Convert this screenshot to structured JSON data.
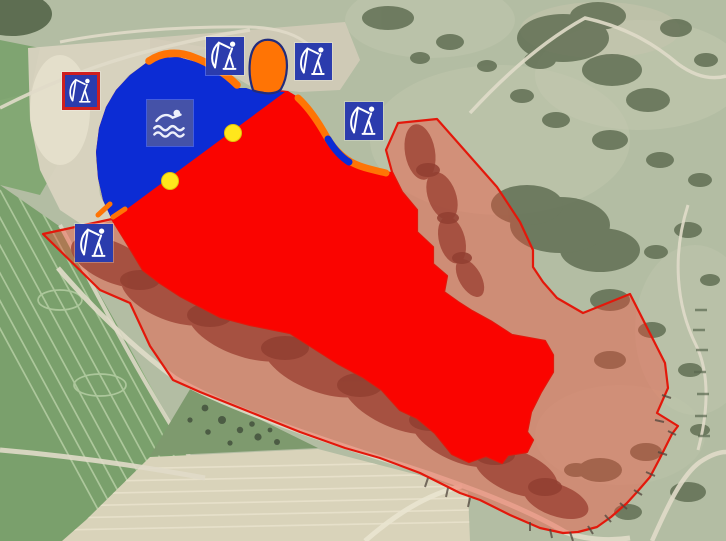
{
  "map": {
    "name": "aerial-lake-zoning-map",
    "colors": {
      "swim_water": "#0c2cd4",
      "restricted_water": "#fa0400",
      "shallow_strip": "#ff7405",
      "shallow_outline": "#222c7c",
      "protected_fill": "rgba(250,62,44,0.38)",
      "protected_outline": "#e3180b",
      "marker_fill": "#ffe71c",
      "marker_edge": "#e0c30a",
      "fishing_icon_bg": "#2b3cad",
      "fishing_icon_border": "#cf1f1f",
      "swimming_icon_bg": "#4a55a5",
      "glyph": "#ffffff"
    },
    "icons": [
      {
        "name": "fishing-spot-icon-west",
        "type": "angler",
        "x": 62,
        "y": 72,
        "size": 38,
        "bordered": true
      },
      {
        "name": "fishing-spot-icon-north-1",
        "type": "angler",
        "x": 206,
        "y": 37,
        "size": 38,
        "bordered": false
      },
      {
        "name": "fishing-spot-icon-north-2",
        "type": "angler",
        "x": 295,
        "y": 43,
        "size": 37,
        "bordered": false
      },
      {
        "name": "fishing-spot-icon-east",
        "type": "angler",
        "x": 345,
        "y": 102,
        "size": 38,
        "bordered": false
      },
      {
        "name": "fishing-spot-icon-south",
        "type": "angler",
        "x": 75,
        "y": 224,
        "size": 38,
        "bordered": false
      },
      {
        "name": "swimming-area-icon",
        "type": "swimmer",
        "x": 147,
        "y": 100,
        "size": 46,
        "bordered": false
      }
    ],
    "markers": [
      {
        "name": "boundary-marker-north",
        "cx": 233,
        "cy": 133,
        "r": 9
      },
      {
        "name": "boundary-marker-south",
        "cx": 170,
        "cy": 181,
        "r": 9
      }
    ]
  }
}
